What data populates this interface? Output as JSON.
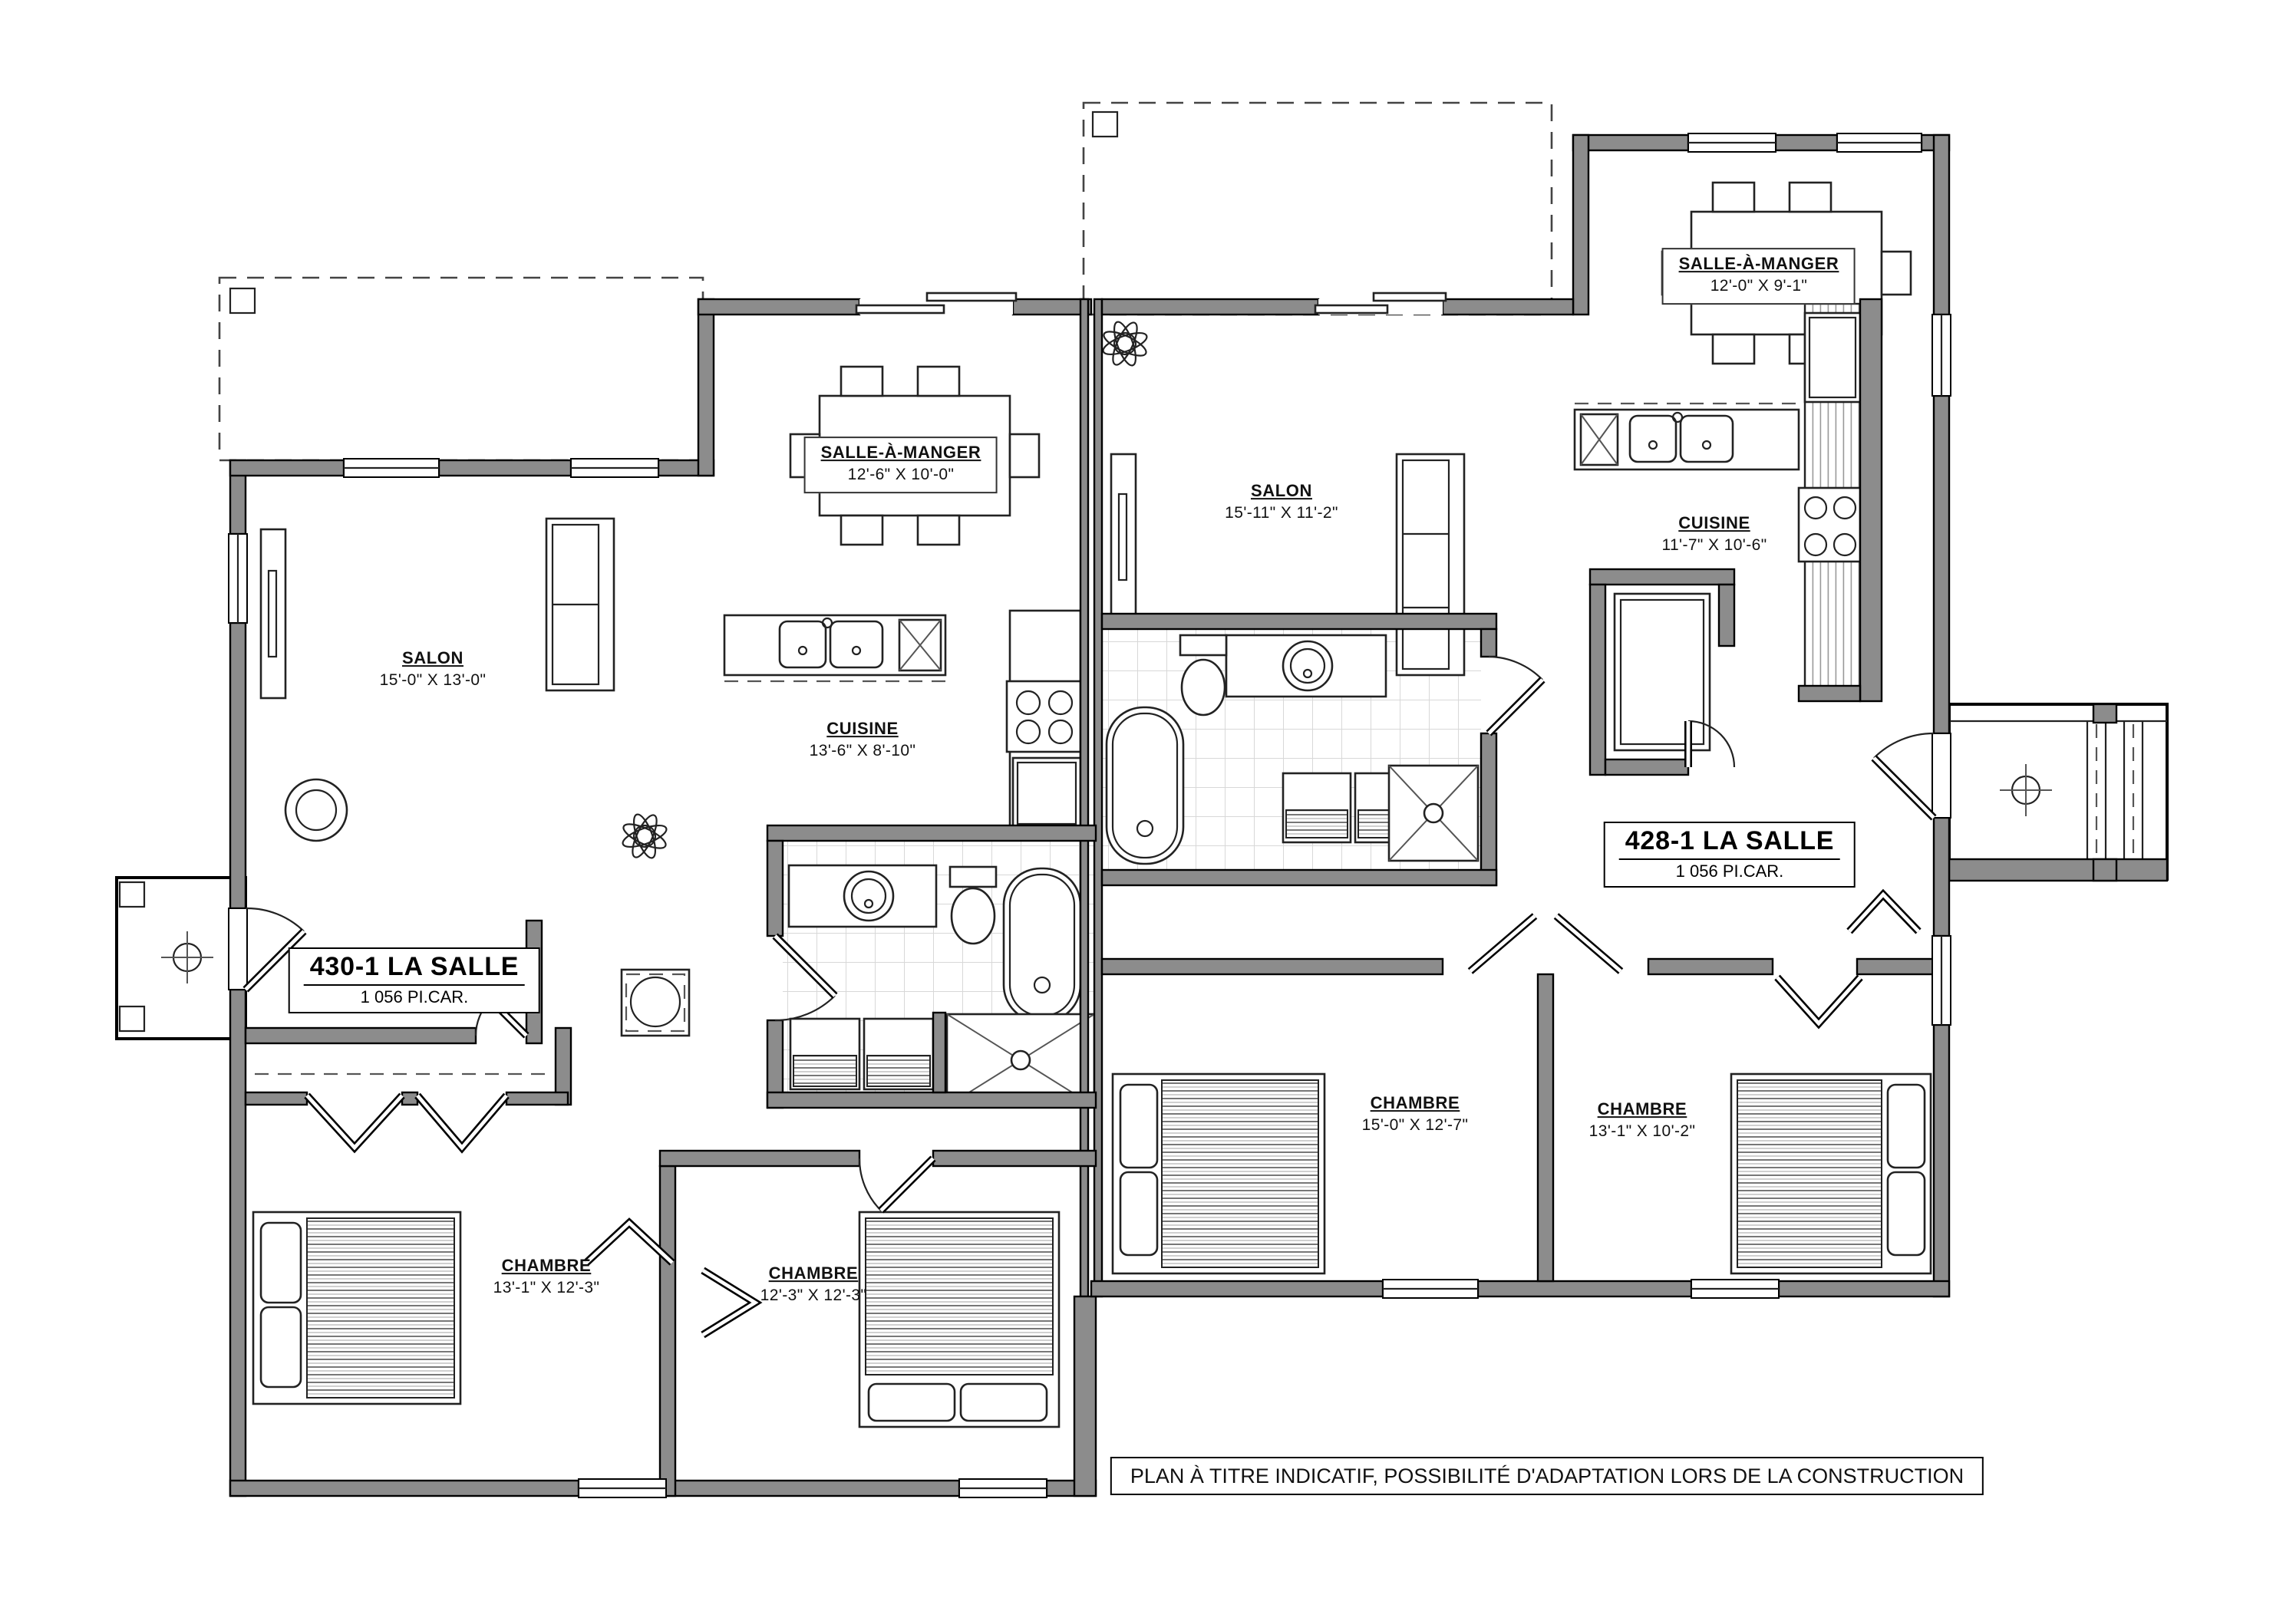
{
  "sheet_title": "floor-plan-duplex-la-salle",
  "colors": {
    "wall_fill": "#8c8c8c",
    "line": "#000000",
    "tile": "#d8d8d8",
    "paper": "#ffffff"
  },
  "units": [
    {
      "name": "430-1 LA SALLE",
      "area": "1 056 PI.CAR.",
      "rooms": [
        {
          "name": "SALON",
          "dims": "15'-0\" X 13'-0\""
        },
        {
          "name": "CUISINE",
          "dims": "13'-6\" X 8'-10\""
        },
        {
          "name": "SALLE-À-MANGER",
          "dims": "12'-6\" X 10'-0\""
        },
        {
          "name": "CHAMBRE",
          "dims": "13'-1\" X 12'-3\""
        },
        {
          "name": "CHAMBRE",
          "dims": "12'-3\" X 12'-3\""
        }
      ]
    },
    {
      "name": "428-1 LA SALLE",
      "area": "1 056 PI.CAR.",
      "rooms": [
        {
          "name": "SALON",
          "dims": "15'-11\" X 11'-2\""
        },
        {
          "name": "CUISINE",
          "dims": "11'-7\" X 10'-6\""
        },
        {
          "name": "SALLE-À-MANGER",
          "dims": "12'-0\" X 9'-1\""
        },
        {
          "name": "CHAMBRE",
          "dims": "15'-0\" X 12'-7\""
        },
        {
          "name": "CHAMBRE",
          "dims": "13'-1\" X 10'-2\""
        }
      ]
    }
  ],
  "disclaimer": "PLAN À TITRE INDICATIF, POSSIBILITÉ D'ADAPTATION LORS DE LA CONSTRUCTION"
}
